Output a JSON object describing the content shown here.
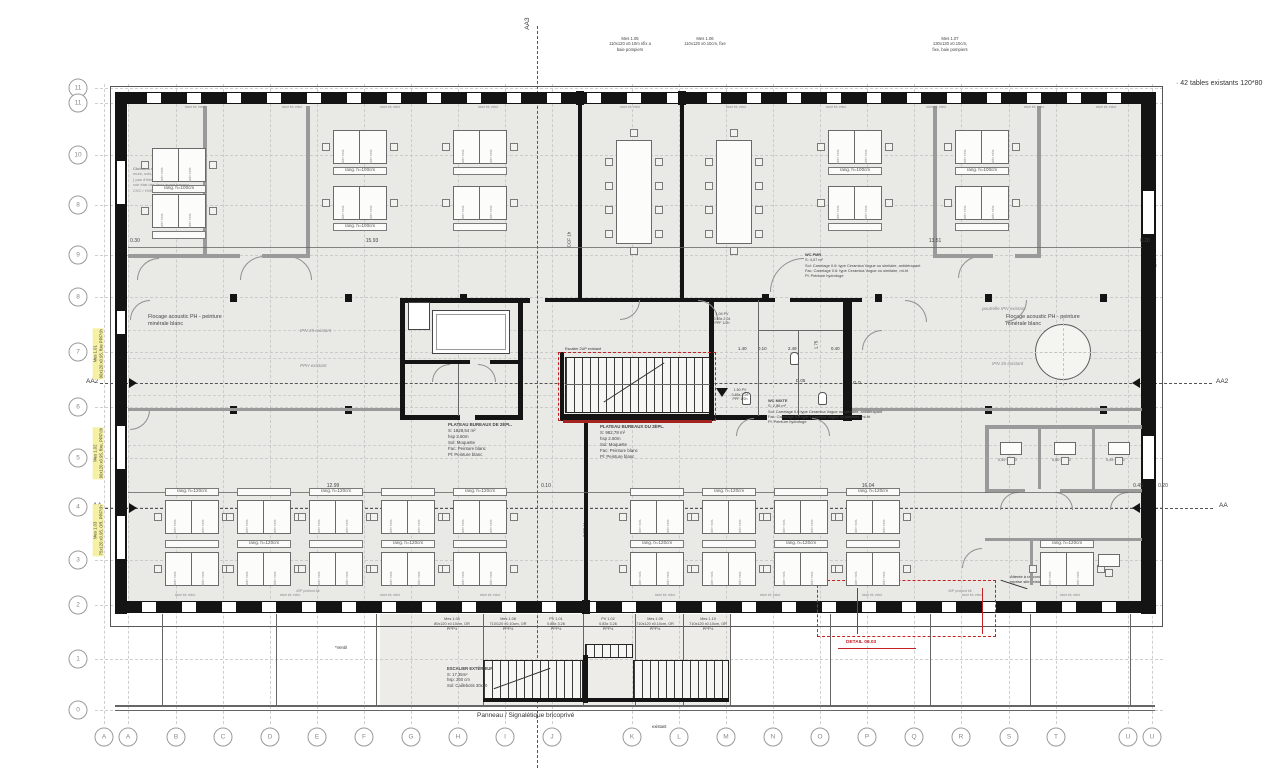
{
  "grid": {
    "rows": [
      "11",
      "11",
      "10",
      "8",
      "9",
      "8",
      "7",
      "6",
      "5",
      "4",
      "3",
      "2",
      "1",
      "0"
    ],
    "cols": [
      "A",
      "A",
      "B",
      "C",
      "D",
      "E",
      "F",
      "G",
      "H",
      "I",
      "J",
      "K",
      "L",
      "M",
      "N",
      "O",
      "P",
      "Q",
      "R",
      "S",
      "T",
      "U",
      "U"
    ]
  },
  "section_markers": {
    "aa3": "AA3",
    "aa2": "AA2",
    "aa": "AA"
  },
  "notes": {
    "tables": "· 42 tables existants 120*80",
    "panneau": "Panneau / Signalétique bricoprivé",
    "ventil": "*Ventil",
    "existant": "existant",
    "ccf": "CCF 1h",
    "store": "store int. exist.",
    "table_exist": "table exist.",
    "rang_top": "rang. h=100cm",
    "rang_bottom": "rang. h=120cm",
    "flocage_l1": "Flocage acoustic PH - peinture",
    "flocage_l2": "minérale blanc",
    "ipn": "IPN 35 existant",
    "pph": "PPH existant",
    "poutre": "poutrelle IPN existant",
    "escalier_2up": "Escalier 2UP existant",
    "profond": "40P profond kit",
    "topleft_note": [
      "Cloisons existantes conservées,",
      "murs, sols, plafonds existants",
      "( pas d'intervention )",
      "voir état des lieux avant travaux",
      "CVC / HVAC ( PU 45 )"
    ]
  },
  "measures": {
    "top": [
      {
        "lines": [
          "Mes 1.05",
          "110x120 x0.10m nfix a",
          "baie pompiers"
        ]
      },
      {
        "lines": [
          "Mes 1.06",
          "110x120 x0.10cm, fixe"
        ]
      },
      {
        "lines": [
          "Mes 1.07",
          "130x130 x0.10cm,",
          "fixe, baie pompiers"
        ]
      }
    ],
    "left": [
      {
        "lines": [
          "Mes 1.01",
          "90x120 x0.95, fixe PPF½h"
        ]
      },
      {
        "lines": [
          "Mes 1.02",
          "90x120 x0.95, fixe, PPF½h"
        ]
      },
      {
        "lines": [
          "Mes 1.03",
          "75x120 x0.95, OR, PPF½h"
        ]
      }
    ],
    "bottom": [
      {
        "lines": [
          "Mes 1.04",
          "80x120 x0.10cm, OR",
          "PPF½"
        ]
      },
      {
        "lines": [
          "Mes 1.08",
          "710/120 x0.10cm, OR",
          "PPF½"
        ]
      },
      {
        "lines": [
          "PV 1.01",
          "0.88x 3.26",
          "PPF½"
        ]
      },
      {
        "lines": [
          "PV 1.02",
          "0.83x 3.26",
          "PPF½"
        ]
      },
      {
        "lines": [
          "Mes 1.09",
          "710x120 x0.10cm, OR",
          "PPF½"
        ]
      },
      {
        "lines": [
          "Mes 1.10",
          "710x120 x0.10cm, OR",
          "PPF½"
        ]
      }
    ],
    "core_small": [
      {
        "lines": [
          "1.04 PV",
          "0.93x 2.04",
          "PPF 1/2h"
        ]
      },
      {
        "lines": [
          "1.50 PV",
          "0.85x 3.26",
          "PPF 1/2h"
        ]
      }
    ]
  },
  "rooms": {
    "plateau_left": [
      "PLATEAU BUREAUX DE 2ÈPL.",
      "S: 1828,54 m²",
      "hsp 2.60m",
      "Sol: Moquette",
      "Fac: Peinture blanc",
      "Pl: Peinture blanc"
    ],
    "plateau_right": [
      "PLATEAU BUREAUX DU 2ÈPL.",
      "S: 982,78 m²",
      "hsp 2.60m",
      "Sol: Moquette",
      "Fac: Peinture blanc",
      "Pl: Peinture blanc"
    ],
    "wc_pmr": [
      "WC PMR",
      "S: 4,07 m²",
      "Sol: Carrelage 0.6: type Ceramica Vogue ou similaire, antidérapant",
      "Fac: Carrelage 0.6: type Ceramica Vogue ou similaire, mi-ht",
      "Pl: Peinture hydrofuge"
    ],
    "wc_mixte": [
      "WC MIXTE",
      "S: 2,86 m²",
      "Sol: Carrelage 0.6 type Ceramica Vogue ou similaire, antidérapant",
      "Fac: Carrelage 0.6 type Ceramica Vogue ou similaire, mi-ht",
      "Pl: Peinture hydrofuge"
    ],
    "escalier_ext": [
      "ESCALIER EXTÉRIEUR",
      "S: 17,35m²",
      "hsp: 260 cm",
      "Sol: Caillebotis 30x30"
    ],
    "ascenseur": [
      "Ascenseur type 1",
      "RdA: 630 kg"
    ],
    "petites": [
      "0,49 x 2,20",
      "0,80 x 2,20",
      "0,49 x 2,20"
    ]
  },
  "details": {
    "d1": "DETAIL 09.02",
    "d2": "DETAIL 09.03",
    "leader": [
      "Attente à raccorder fen.109 sur site,",
      "reprise site existant MOE"
    ]
  },
  "dims": {
    "top": [
      "0.30",
      "15.93",
      "13.51",
      "0.20"
    ],
    "bottom": [
      "12.99",
      "0.10",
      "16.04",
      "0.45",
      "0.20"
    ],
    "core": [
      "1.40",
      "0.10",
      "2.49",
      "0.40"
    ],
    "core_v": "1.75",
    "right_v": "0.44",
    "d05": "D.05",
    "go": "G.O"
  },
  "colors": {
    "red": "#c42126",
    "floor": "#e9e9e6",
    "wall": "#141414",
    "partition": "#9a9a9a",
    "highlight": "#f5f1a0"
  }
}
